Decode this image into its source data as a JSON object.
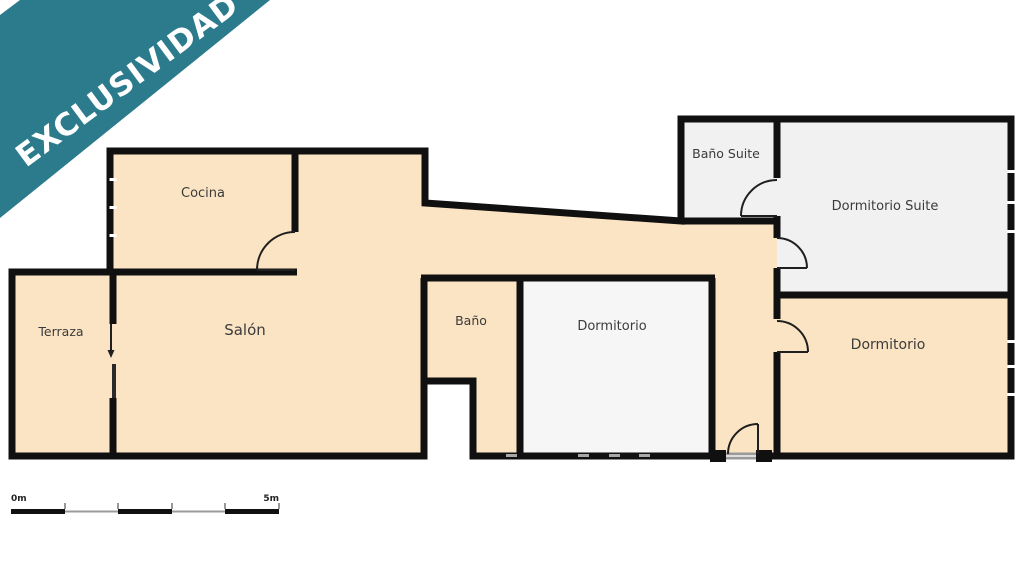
{
  "banner": {
    "label": "EXCLUSIVIDAD",
    "bg_color": "#2b7b8c",
    "text_color": "#ffffff"
  },
  "rooms": [
    {
      "id": "cocina",
      "name": "Cocina"
    },
    {
      "id": "terraza",
      "name": "Terraza"
    },
    {
      "id": "salon",
      "name": "Salón"
    },
    {
      "id": "bano",
      "name": "Baño"
    },
    {
      "id": "dormitorio",
      "name": "Dormitorio"
    },
    {
      "id": "bano-suite",
      "name": "Baño Suite"
    },
    {
      "id": "dormitorio-suite",
      "name": "Dormitorio Suite"
    },
    {
      "id": "dormitorio-2",
      "name": "Dormitorio"
    }
  ],
  "scale_bar": {
    "start_label": "0m",
    "end_label": "5m"
  },
  "colors": {
    "floor_main": "#fbe4c4",
    "floor_suite": "#f1f1f1",
    "floor_dormitorio": "#f6f6f6",
    "wall": "#101010",
    "door": "#1f1f1f",
    "label": "#3b3b3b",
    "scale_gray": "#9b9b9b",
    "window_tick": "#a8a8a8"
  }
}
